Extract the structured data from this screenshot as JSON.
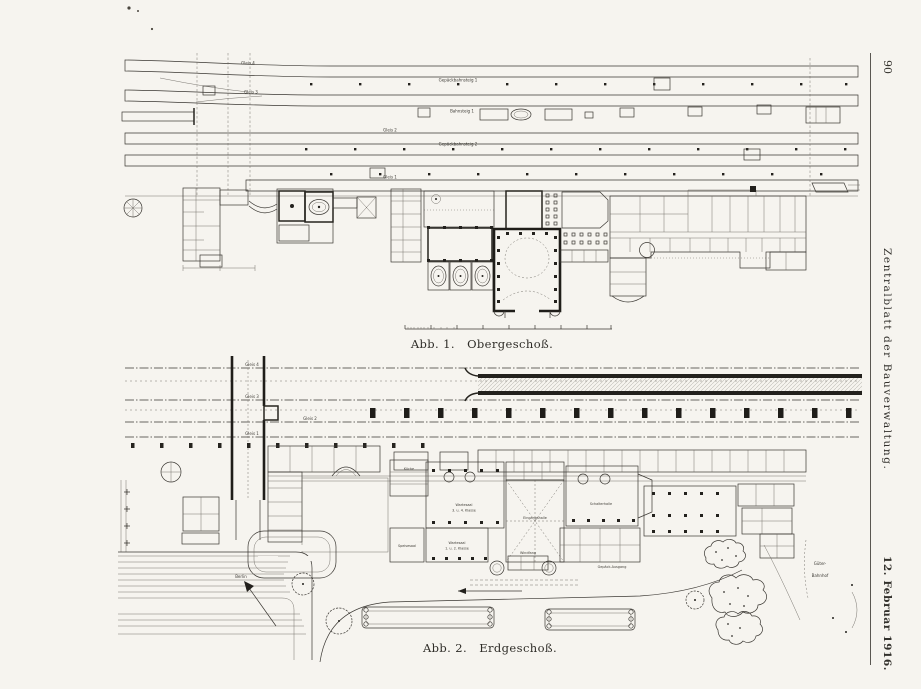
{
  "margin": {
    "page_number": "90",
    "journal_title": "Zentralblatt der Bauverwaltung.",
    "issue_date": "12. Februar 1916."
  },
  "figures": [
    {
      "caption": "Abb. 1.   Obergeschoß.",
      "labels": {
        "gleis4": "Gleis 4",
        "gleis3": "Gleis 3",
        "gleis2": "Gleis 2",
        "gleis1": "Gleis 1",
        "gepaeckbahnsteig1": "Gepäckbahnsteig 1",
        "bahnsteig1": "Bahnsteig 1",
        "gepaeckbahnsteig2": "Gepäckbahnsteig 2"
      }
    },
    {
      "caption": "Abb. 2.   Erdgeschoß.",
      "labels": {
        "gleis4": "Gleis 4",
        "gleis3": "Gleis 3",
        "gleis2": "Gleis 2",
        "gleis1": "Gleis 1",
        "kueche": "Küche",
        "wartesaal34_l1": "Wartesaal",
        "wartesaal34_l2": "3. u. 4. Klasse",
        "wartesaal12_l1": "Wartesaal",
        "wartesaal12_l2": "1. u. 2. Klasse",
        "speisesaal": "Speisesaal",
        "eingangshalle": "Eingangshalle",
        "schalterhalle": "Schalterhalle",
        "windfang": "Windfang",
        "gepaeck_ausgang": "Gepäck-Ausgang",
        "berlin": "Berlin",
        "gueterbahnhof_l1": "Güter-",
        "gueterbahnhof_l2": "Bahnhof"
      }
    }
  ],
  "colors": {
    "ink": "#3a3732",
    "paper": "#f6f4ef"
  }
}
